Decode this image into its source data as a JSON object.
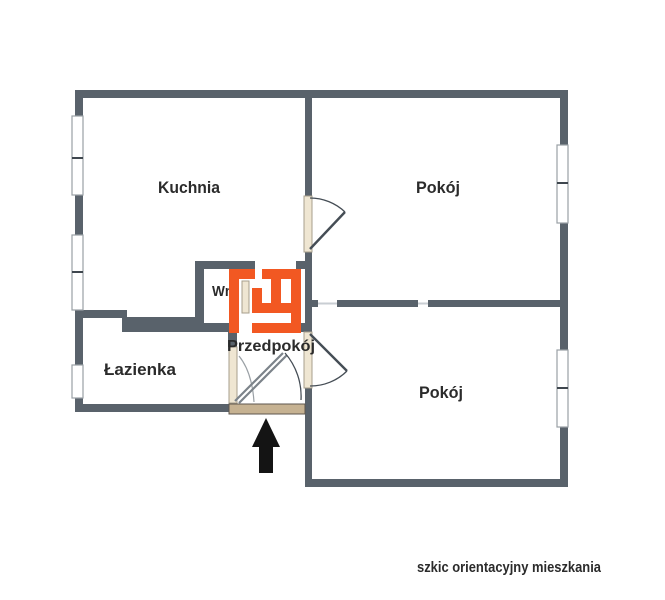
{
  "floor_plan": {
    "caption": "szkic orientacyjny mieszkania",
    "rooms": {
      "kitchen": "Kuchnia",
      "room_upper": "Pokój",
      "room_lower": "Pokój",
      "bathroom": "Łazienka",
      "alcove": "Wnęka",
      "hallway": "Przedpokój"
    },
    "colors": {
      "wall": "#59626B",
      "highlight": "#F25822",
      "door": "#EFE6D2",
      "entrance_sill": "#C6B292",
      "window_frame": "#9AA0A5",
      "label": "#2B2B2B",
      "arrow": "#141414",
      "background": "#FFFFFF"
    },
    "icons": {
      "entrance_arrow": "up-arrow"
    }
  }
}
